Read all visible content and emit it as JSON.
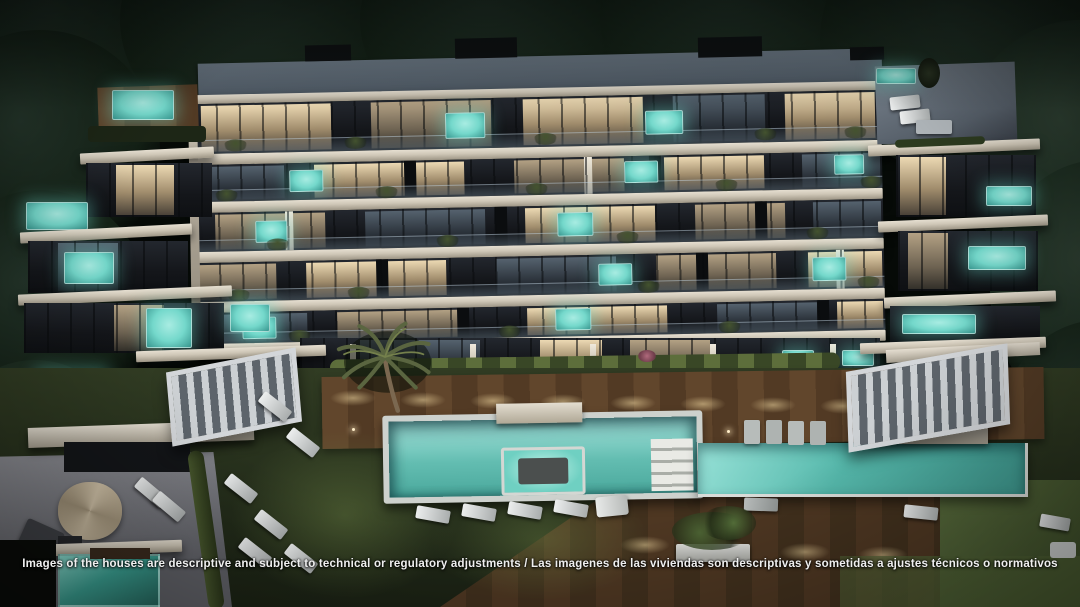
{
  "image": {
    "description": "Night-time aerial architectural rendering of a modern terraced apartment building with balcony plunge pools, rooftop terraces, landscaped gardens, sun loungers, pergolas, a palm tree and a long outdoor swimming pool",
    "caption": "Images of the houses are descriptive and subject to technical or regulatory adjustments / Las imagenes de las viviendas son descriptivas y sometidas a ajustes técnicos o normativos"
  },
  "palette": {
    "night_sky": "#060a07",
    "foliage": "#142116",
    "foliage_lit": "#24352a",
    "roof": "#66737f",
    "facade_slab": "#d7d0c2",
    "balcony_dark": "#17191d",
    "room_warm": "#cdb795",
    "pool_teal": "#74d8cb",
    "pool_deep": "#3f9e96",
    "pool_glow": "#a8ece2",
    "lawn": "#2a341e",
    "lawn_lit": "#4f6233",
    "deck": "#5a4129",
    "patio_stone": "#7c7d85",
    "furniture_white": "#d6d8d9",
    "caption_text": "#efefef"
  }
}
